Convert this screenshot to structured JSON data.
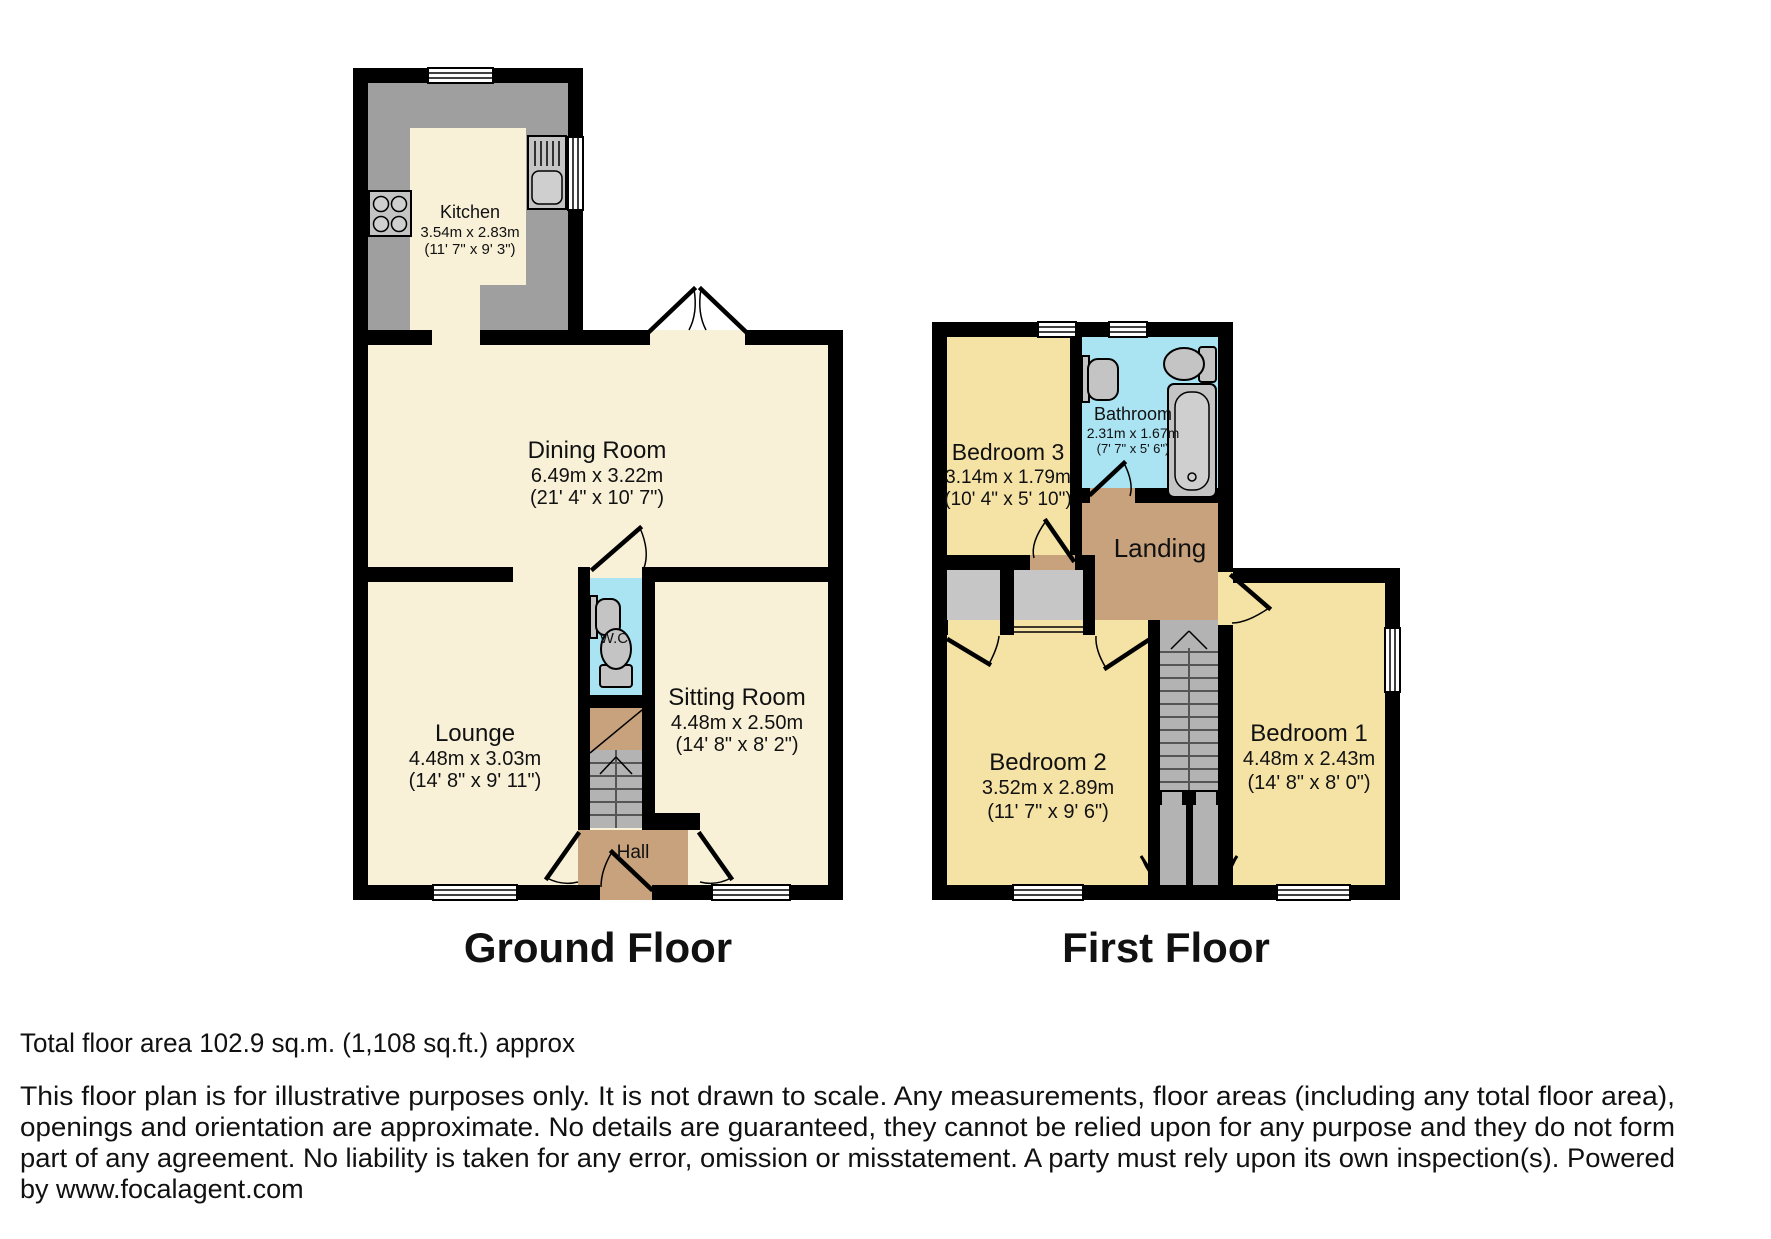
{
  "ground_floor": {
    "title": "Ground Floor",
    "rooms": {
      "kitchen": {
        "name": "Kitchen",
        "metric": "3.54m x 2.83m",
        "imperial": "(11' 7\" x 9' 3\")"
      },
      "dining": {
        "name": "Dining Room",
        "metric": "6.49m x 3.22m",
        "imperial": "(21' 4\" x 10' 7\")"
      },
      "lounge": {
        "name": "Lounge",
        "metric": "4.48m x 3.03m",
        "imperial": "(14' 8\" x 9' 11\")"
      },
      "sitting": {
        "name": "Sitting Room",
        "metric": "4.48m x 2.50m",
        "imperial": "(14' 8\" x 8' 2\")"
      },
      "wc": {
        "name": "W.C."
      },
      "hall": {
        "name": "Hall"
      }
    }
  },
  "first_floor": {
    "title": "First Floor",
    "rooms": {
      "bedroom3": {
        "name": "Bedroom 3",
        "metric": "3.14m x 1.79m",
        "imperial": "(10' 4\" x 5' 10\")"
      },
      "bathroom": {
        "name": "Bathroom",
        "metric": "2.31m x 1.67m",
        "imperial": "(7' 7\" x 5' 6\")"
      },
      "landing": {
        "name": "Landing"
      },
      "bedroom2": {
        "name": "Bedroom 2",
        "metric": "3.52m x 2.89m",
        "imperial": "(11' 7\" x 9' 6\")"
      },
      "bedroom1": {
        "name": "Bedroom 1",
        "metric": "4.48m x 2.43m",
        "imperial": "(14' 8\" x 8' 0\")"
      }
    }
  },
  "footer": {
    "total_area": "Total floor area 102.9 sq.m. (1,108 sq.ft.) approx",
    "disclaimer": [
      "This floor plan is for illustrative purposes only. It is not drawn to scale. Any measurements, floor areas (including any total floor area),",
      "openings and orientation are approximate. No details are guaranteed, they cannot be relied upon for any purpose and they do not form",
      "part of any agreement. No liability is taken for any error, omission or misstatement. A party must rely upon its own inspection(s). Powered",
      "by www.focalagent.com"
    ]
  },
  "colors": {
    "wall": "#000000",
    "ground_floor_fill": "#f8f1d8",
    "first_floor_fill": "#f5e3a6",
    "wet_room_fill": "#aae3f2",
    "hall_landing_fill": "#c8a27d",
    "counter_gray": "#9f9f9f",
    "stair_gray": "#b3b3b3",
    "closet_gray": "#c6c6c6"
  }
}
